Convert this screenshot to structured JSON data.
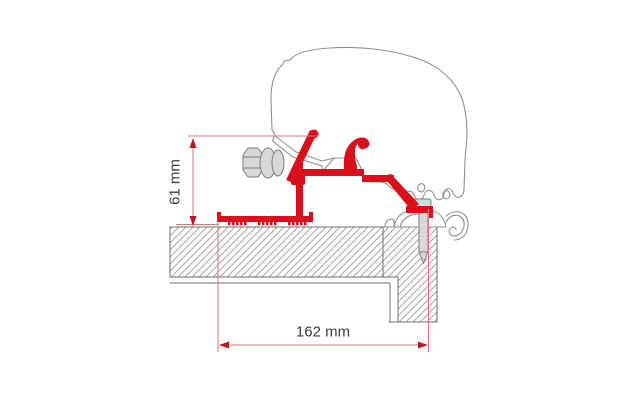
{
  "diagram": {
    "dimension_labels": {
      "height": "61 mm",
      "width": "162 mm"
    },
    "colors": {
      "adapter_red": "#d8101c",
      "dimension_line_red": "#d27878",
      "arrow_red": "#c1121f",
      "outline_gray": "#8f8f8f",
      "structure_gray": "#6f6f6f",
      "metal_fill_gray": "#d8d8d8",
      "metal_stroke_gray": "#7d7d7d",
      "label_text": "#3d3d3d",
      "background": "#ffffff"
    }
  }
}
